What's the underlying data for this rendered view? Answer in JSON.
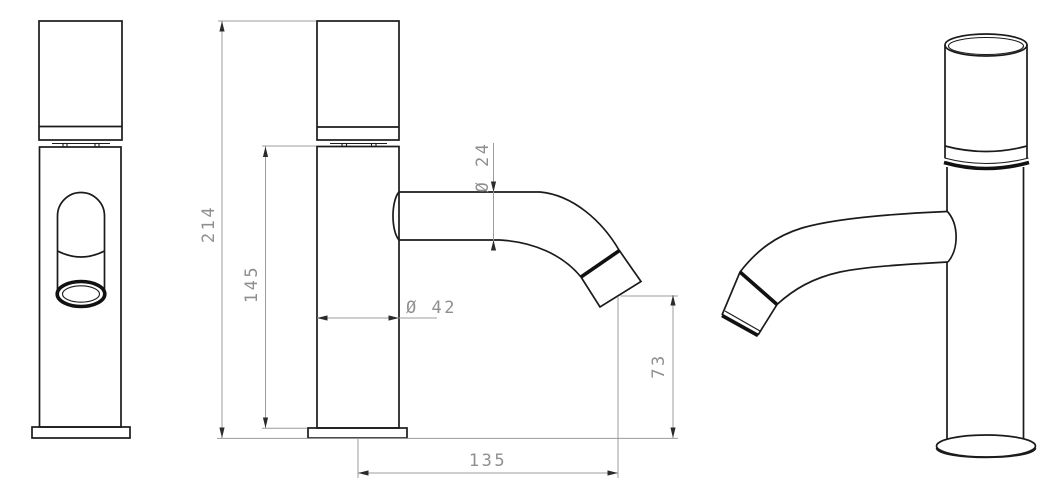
{
  "drawing": {
    "kind": "faucet-dimension-drawing",
    "dimensions": {
      "total_height": "214",
      "body_height": "145",
      "spout_diameter": "Ø 24",
      "body_diameter": "Ø 42",
      "outlet_height": "73",
      "spout_reach": "135"
    },
    "colors": {
      "object_line": "#1b1b1b",
      "dimension_line": "#9c9c9c",
      "dimension_text": "#8f8f8f",
      "background": "#ffffff"
    }
  }
}
